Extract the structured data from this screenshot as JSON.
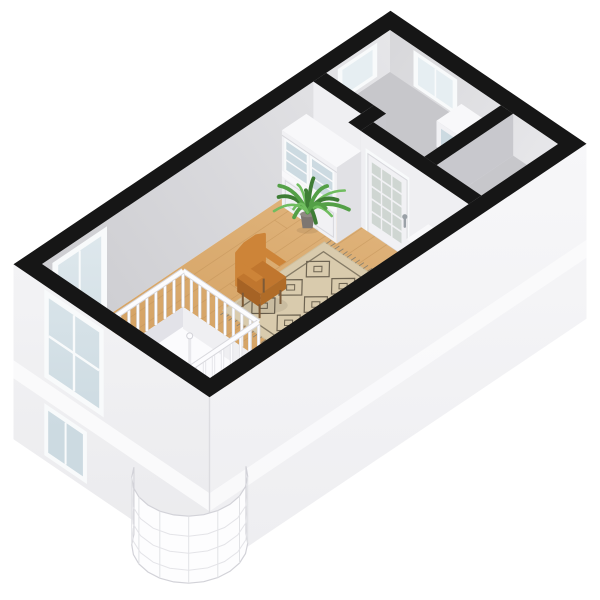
{
  "scene": {
    "title": "3D isometric floor plan - studio apartment dollhouse view, upper floor",
    "projection": "isometric",
    "background": "#ffffff"
  },
  "palette": {
    "capBlack": "#161616",
    "wallNWLight": "#e6e6e9",
    "wallNWDark": "#cdcdd1",
    "wallNELight": "#e7e7ea",
    "wallNEDark": "#d7d7da",
    "wallFront": "#efeff2",
    "wallFrontDeep": "#e3e3e7",
    "wallSide": "#c8c8cd",
    "extTop": "#f3f3f5",
    "extBottom": "#e9e9ec",
    "extSETop": "#f7f7f9",
    "extSEBottom": "#ededf0",
    "slab": "#fafafb",
    "cornerLine": "#dcdce0",
    "woodLight": "#e0b47c",
    "woodDark": "#cf9a58",
    "plankLine": "#c3945a",
    "floorGray": "#c7c7cb",
    "floorGrayEdge": "#b3b3b9",
    "glassLight": "#e6eef2",
    "glassDark": "#ccdae1",
    "glassFrame": "#f8fafb",
    "doorPane": "#cfd6d2",
    "handleGray": "#9aa1a7",
    "cabinetWhite": "#f1f1f4",
    "cabinetTop": "#f8f8fa",
    "cabinetSide": "#e1e1e5",
    "cabinetLine": "#d8d8dd",
    "rugBase": "#d9cbad",
    "rugShade": "#cec0a0",
    "rugBorder": "#857b66",
    "rugPattern": "#6e6452",
    "rugFringe": "#8c8371",
    "chairBody": "#c0762e",
    "chairDark": "#a66325",
    "chairLight": "#cd8438",
    "chairLeg": "#7c5a38",
    "plantDark": "#3e7d35",
    "plantMid": "#54a047",
    "plantLight": "#70bd5f",
    "potBody": "#7d7671",
    "potRim": "#8f8983",
    "stairWhite": "#fdfdfe",
    "stairEdge": "#d2d2d8",
    "railWhite": "#fcfcfe",
    "railEdge": "#d8d8dd",
    "voidWhite": "#fbfbfd",
    "voidShadow": "#e2e2e8",
    "shadow": "rgba(0,0,0,0.07)"
  },
  "rooms": [
    {
      "id": "living-room",
      "floor": "oak wood"
    },
    {
      "id": "back-study",
      "floor": "gray"
    },
    {
      "id": "closet",
      "floor": "gray"
    },
    {
      "id": "entry-strip",
      "floor": "gray"
    }
  ],
  "objects": [
    "french-door",
    "built-in-hutch",
    "hall-display-cabinet",
    "low-cabinet",
    "potted-plant",
    "berber-rug",
    "cognac-armchair",
    "stair-railing",
    "spiral-staircase",
    "facade-windows",
    "interior-windows"
  ]
}
